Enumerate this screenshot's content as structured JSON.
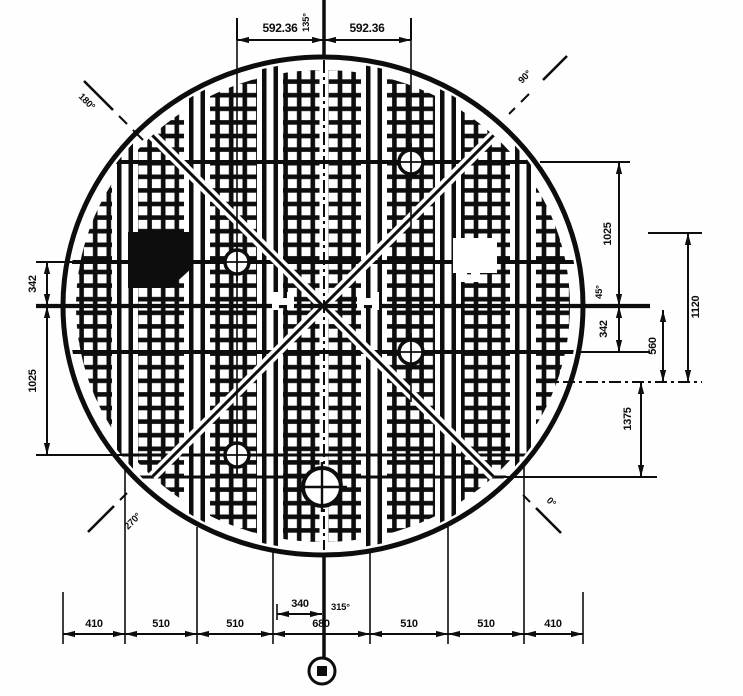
{
  "drawing": {
    "kind": "engineering-plan-drawing",
    "subject": "circular grated plate / tank bottom plan view",
    "line_color": "#0d0d0d",
    "background": "#fefefe",
    "symbols": [
      "grating-grid",
      "stiffener-band",
      "crosshair-hole-marker",
      "datum-target-symbol",
      "diagonal-brace"
    ]
  },
  "dims": {
    "top_left": "592.36",
    "top_right": "592.36",
    "left_upper": "342",
    "left_lower": "1025",
    "right_upper": "1025",
    "right_mid": "342",
    "right_1120": "1120",
    "right_560": "560",
    "right_1375": "1375",
    "bottom": [
      "410",
      "510",
      "510",
      "680",
      "510",
      "510",
      "410"
    ],
    "bottom_half_center": "340"
  },
  "angles": {
    "north": "135°",
    "northeast": "90°",
    "east": "45°",
    "southeast": "0°",
    "south": "315°",
    "southwest": "270°",
    "northwest": "180°"
  }
}
